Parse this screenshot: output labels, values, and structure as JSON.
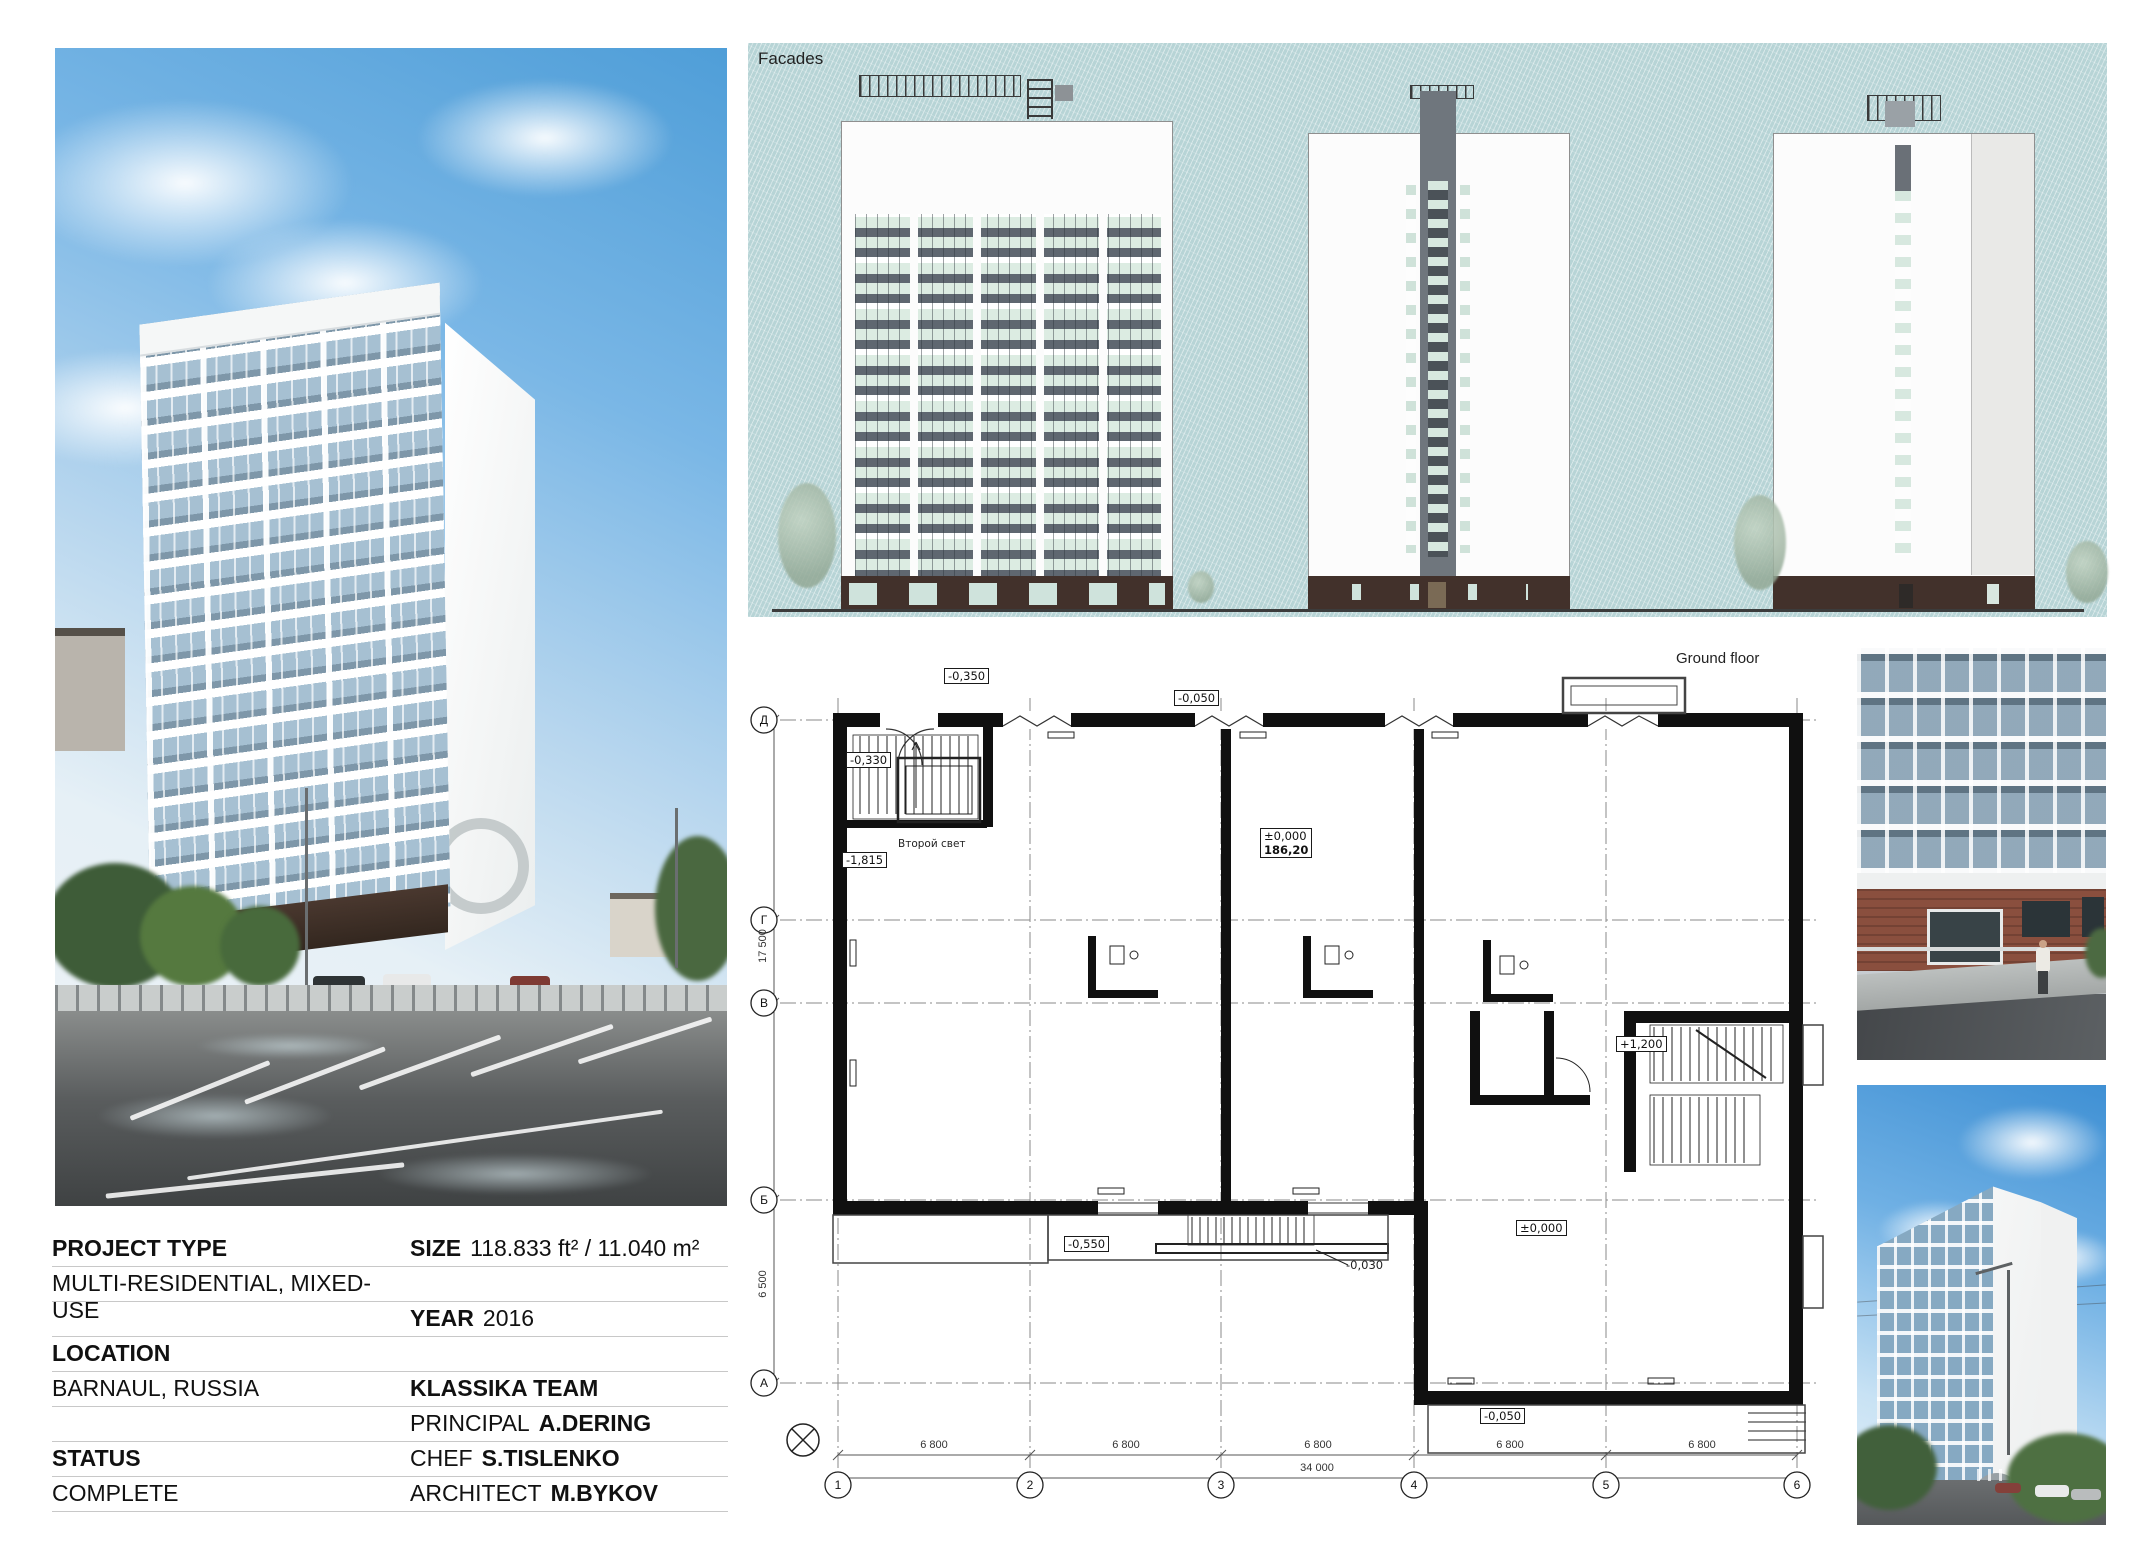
{
  "colors": {
    "facades_bg": "#b7d4d6",
    "base_brown": "#42312b",
    "glass": "#dcece2",
    "spandrel": "#5f6770",
    "sky": "#4f9ed8",
    "brick": "#8a4f3e"
  },
  "facades": {
    "panel_label": "Facades",
    "building_sign": "Досуговый центр жилого комплекса \"Локомотив\""
  },
  "plan": {
    "panel_label": "Ground floor",
    "grid": {
      "columns": [
        "1",
        "2",
        "3",
        "4",
        "5",
        "6"
      ],
      "rows": [
        "Д",
        "Г",
        "В",
        "Б",
        "А"
      ]
    },
    "dims": {
      "bays": [
        "6 800",
        "6 800",
        "6 800",
        "6 800",
        "6 800"
      ],
      "total": "34 000",
      "left_upper": "17 500",
      "left_lower": "6 500"
    },
    "marks": {
      "entry_left": "-0,350",
      "entry_mid": "-0,050",
      "stair_top": "-0,330",
      "stair_pit": "-1,815",
      "second_light": "Второй свет",
      "level_zero": "±0,000",
      "level_area": "186,20",
      "porch_left": "-0,550",
      "porch_step": "-0,030",
      "stair_right": "+1,200",
      "hall_level": "±0,000",
      "porch_right": "-0,050"
    }
  },
  "info": {
    "project_type": {
      "label": "PROJECT TYPE",
      "value": "MULTI-RESIDENTIAL, MIXED-USE"
    },
    "size": {
      "label": "SIZE",
      "value": "118.833 ft² / 11.040 m²"
    },
    "year": {
      "label": "YEAR",
      "value": "2016"
    },
    "location": {
      "label": "LOCATION",
      "value": "BARNAUL, RUSSIA"
    },
    "status": {
      "label": "STATUS",
      "value": "COMPLETE"
    },
    "team": {
      "name": "KLASSIKA TEAM",
      "principal_role": "PRINCIPAL",
      "principal_name": "A.DERING",
      "chef_role": "CHEF",
      "chef_name": "S.TISLENKO",
      "architect_role": "ARCHITECT",
      "architect_name": "M.BYKOV"
    }
  }
}
